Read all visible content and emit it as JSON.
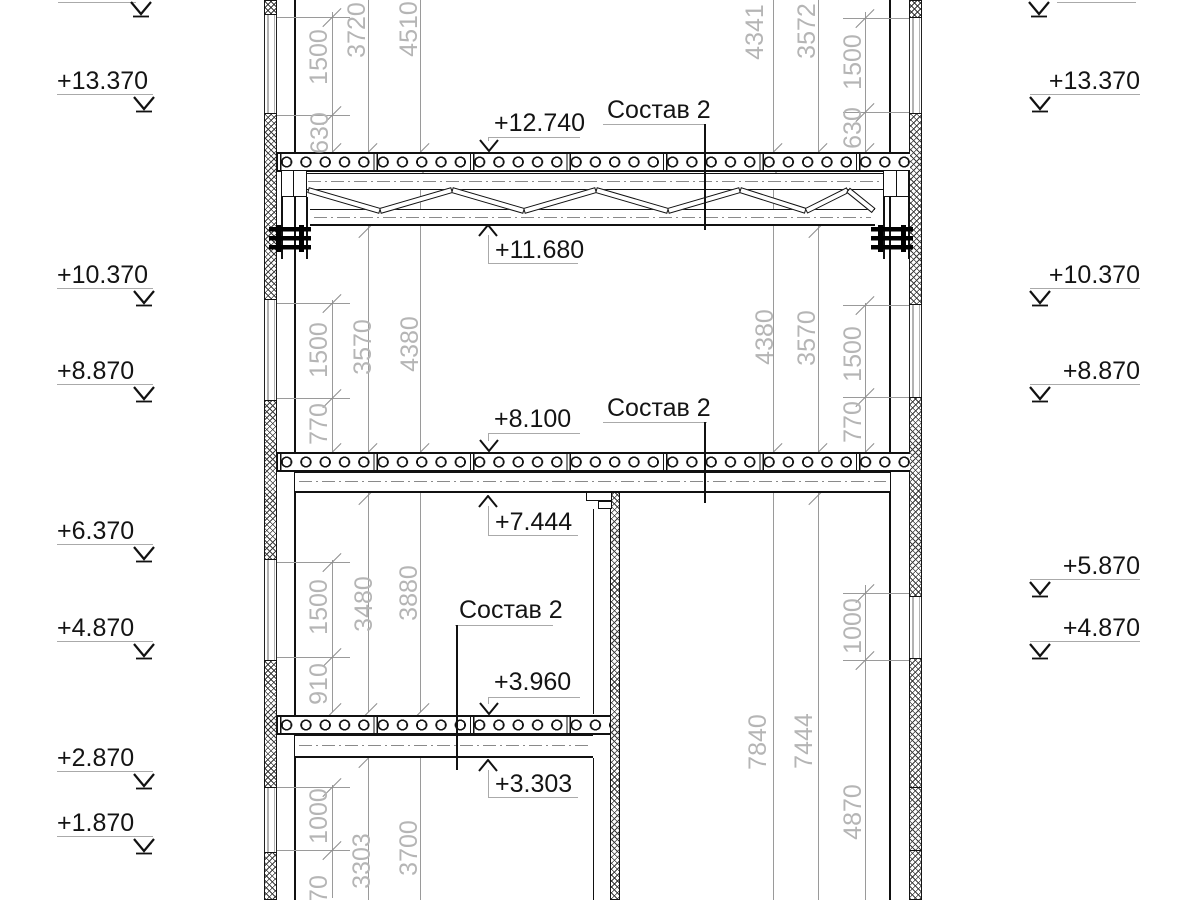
{
  "labels": {
    "composition": "Состав 2"
  },
  "elevations": {
    "left": [
      "+13.370",
      "+10.370",
      "+8.870",
      "+6.370",
      "+4.870",
      "+2.870",
      "+1.870"
    ],
    "right": [
      "+13.370",
      "+10.370",
      "+8.870",
      "+5.870",
      "+4.870"
    ]
  },
  "callouts": {
    "v12740": "+12.740",
    "v11680": "+11.680",
    "v8100": "+8.100",
    "v7444": "+7.444",
    "v3960": "+3.960",
    "v3303": "+3.303"
  },
  "dimensions": {
    "left": {
      "top": [
        "1500",
        "630",
        "3720",
        "4510"
      ],
      "mid": [
        "1500",
        "770",
        "3570",
        "4380"
      ],
      "low": [
        "1500",
        "910",
        "3480",
        "3880"
      ],
      "bottom": [
        "1000",
        "970",
        "3303",
        "3700"
      ]
    },
    "right": {
      "top": [
        "1500",
        "630",
        "3572",
        "4341"
      ],
      "mid": [
        "1500",
        "770",
        "3570",
        "4380"
      ],
      "bottom": [
        "1000",
        "4870",
        "7444",
        "7840"
      ]
    }
  }
}
